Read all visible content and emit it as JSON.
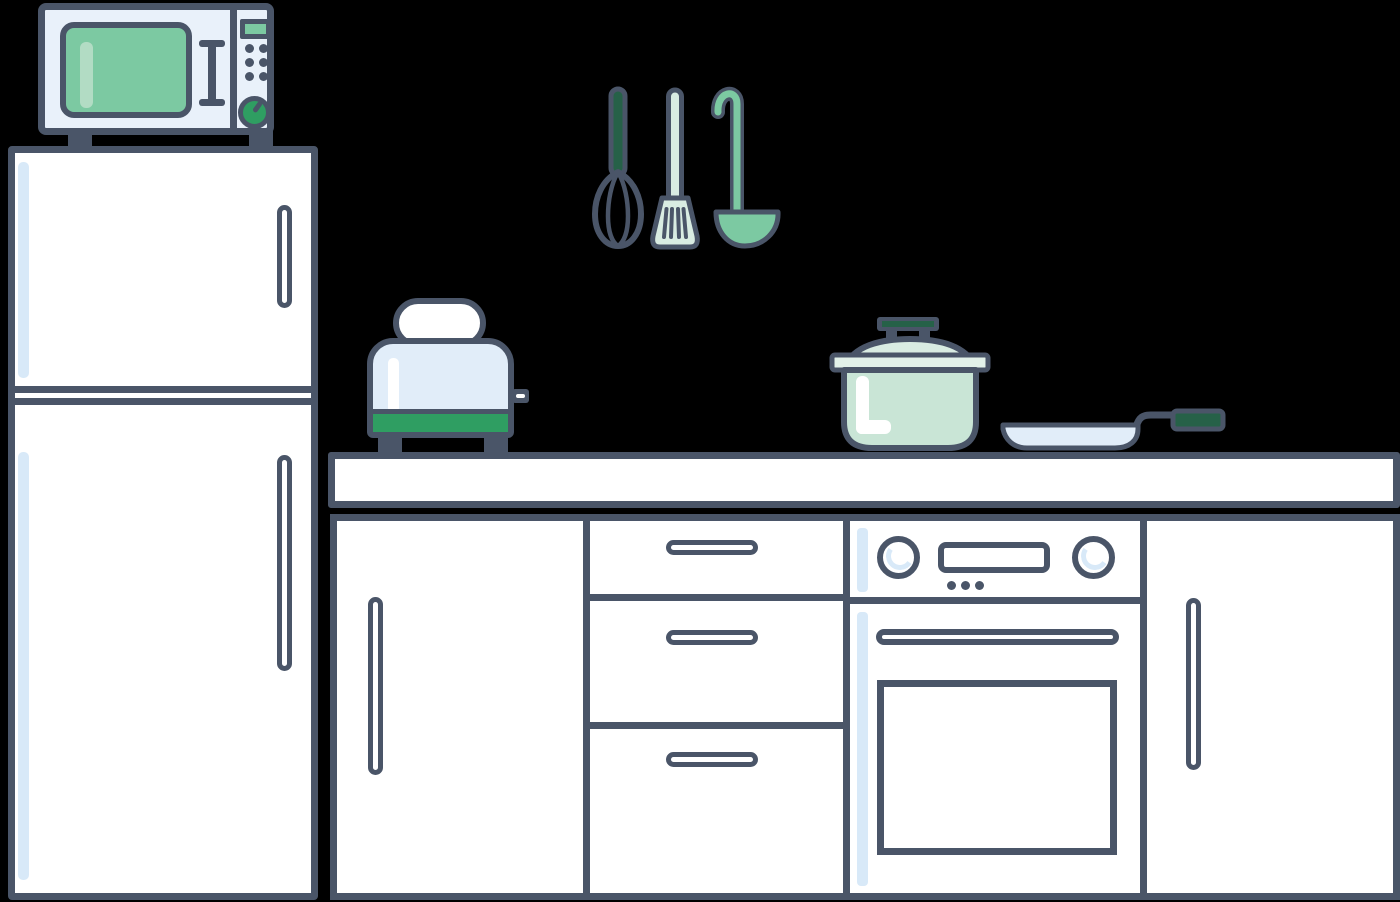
{
  "meta": {
    "title": "Flat kitchen scene illustration",
    "background": "#000000"
  },
  "palette": {
    "bg": "#000000",
    "outline": "#4a5568",
    "white": "#ffffff",
    "panel-blue": "#e9f1fa",
    "appliance-blue": "#e1edf9",
    "stripe-blue": "#d8e9f8",
    "green-strong": "#2f9e62",
    "green-mid": "#7cc9a2",
    "green-dark": "#266148",
    "mint-light": "#d9ece2",
    "mint-pale": "#e2f1e9",
    "pot-mint": "#c9e5d6",
    "highlight-green": "#b2dcc4"
  },
  "scene": {
    "items": {
      "microwave": {
        "label": "Microwave oven with green window, keypad and dial"
      },
      "refrigerator": {
        "label": "Two-door refrigerator"
      },
      "utensils": {
        "label": "Hanging utensils: whisk, slotted spatula, ladle"
      },
      "toaster": {
        "label": "Toaster with bread slice"
      },
      "pot": {
        "label": "Mint cooking pot with lid"
      },
      "pan": {
        "label": "Frying pan with green handle grip"
      },
      "counter": {
        "label": "Kitchen countertop"
      },
      "cabinets": {
        "label": "Base cabinets with cupboard doors and three drawers"
      },
      "oven": {
        "label": "Built-in oven with two knobs and display"
      }
    }
  }
}
